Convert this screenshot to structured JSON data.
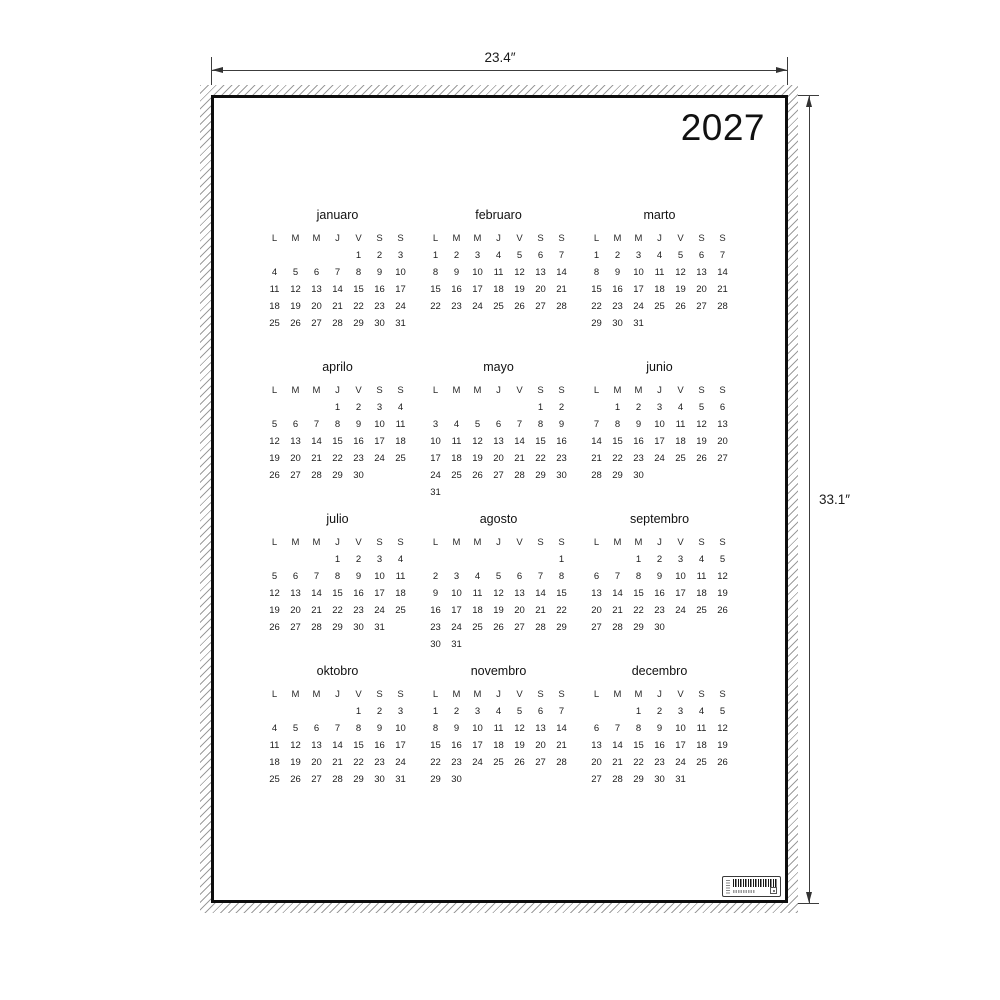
{
  "dimension_annotations": {
    "width_label": "23.4″",
    "height_label": "33.1″"
  },
  "poster": {
    "year": "2027",
    "day_headers": [
      "L",
      "M",
      "M",
      "J",
      "V",
      "S",
      "S"
    ],
    "months": [
      {
        "name": "januaro",
        "weeks": [
          [
            "",
            "",
            "",
            "",
            "1",
            "2",
            "3"
          ],
          [
            "4",
            "5",
            "6",
            "7",
            "8",
            "9",
            "10"
          ],
          [
            "11",
            "12",
            "13",
            "14",
            "15",
            "16",
            "17"
          ],
          [
            "18",
            "19",
            "20",
            "21",
            "22",
            "23",
            "24"
          ],
          [
            "25",
            "26",
            "27",
            "28",
            "29",
            "30",
            "31"
          ]
        ]
      },
      {
        "name": "februaro",
        "weeks": [
          [
            "1",
            "2",
            "3",
            "4",
            "5",
            "6",
            "7"
          ],
          [
            "8",
            "9",
            "10",
            "11",
            "12",
            "13",
            "14"
          ],
          [
            "15",
            "16",
            "17",
            "18",
            "19",
            "20",
            "21"
          ],
          [
            "22",
            "23",
            "24",
            "25",
            "26",
            "27",
            "28"
          ]
        ]
      },
      {
        "name": "marto",
        "weeks": [
          [
            "1",
            "2",
            "3",
            "4",
            "5",
            "6",
            "7"
          ],
          [
            "8",
            "9",
            "10",
            "11",
            "12",
            "13",
            "14"
          ],
          [
            "15",
            "16",
            "17",
            "18",
            "19",
            "20",
            "21"
          ],
          [
            "22",
            "23",
            "24",
            "25",
            "26",
            "27",
            "28"
          ],
          [
            "29",
            "30",
            "31",
            "",
            "",
            "",
            ""
          ]
        ]
      },
      {
        "name": "aprilo",
        "weeks": [
          [
            "",
            "",
            "",
            "1",
            "2",
            "3",
            "4"
          ],
          [
            "5",
            "6",
            "7",
            "8",
            "9",
            "10",
            "11"
          ],
          [
            "12",
            "13",
            "14",
            "15",
            "16",
            "17",
            "18"
          ],
          [
            "19",
            "20",
            "21",
            "22",
            "23",
            "24",
            "25"
          ],
          [
            "26",
            "27",
            "28",
            "29",
            "30",
            "",
            ""
          ]
        ]
      },
      {
        "name": "mayo",
        "weeks": [
          [
            "",
            "",
            "",
            "",
            "",
            "1",
            "2"
          ],
          [
            "3",
            "4",
            "5",
            "6",
            "7",
            "8",
            "9"
          ],
          [
            "10",
            "11",
            "12",
            "13",
            "14",
            "15",
            "16"
          ],
          [
            "17",
            "18",
            "19",
            "20",
            "21",
            "22",
            "23"
          ],
          [
            "24",
            "25",
            "26",
            "27",
            "28",
            "29",
            "30"
          ],
          [
            "31",
            "",
            "",
            "",
            "",
            "",
            ""
          ]
        ]
      },
      {
        "name": "junio",
        "weeks": [
          [
            "",
            "1",
            "2",
            "3",
            "4",
            "5",
            "6"
          ],
          [
            "7",
            "8",
            "9",
            "10",
            "11",
            "12",
            "13"
          ],
          [
            "14",
            "15",
            "16",
            "17",
            "18",
            "19",
            "20"
          ],
          [
            "21",
            "22",
            "23",
            "24",
            "25",
            "26",
            "27"
          ],
          [
            "28",
            "29",
            "30",
            "",
            "",
            "",
            ""
          ]
        ]
      },
      {
        "name": "julio",
        "weeks": [
          [
            "",
            "",
            "",
            "1",
            "2",
            "3",
            "4"
          ],
          [
            "5",
            "6",
            "7",
            "8",
            "9",
            "10",
            "11"
          ],
          [
            "12",
            "13",
            "14",
            "15",
            "16",
            "17",
            "18"
          ],
          [
            "19",
            "20",
            "21",
            "22",
            "23",
            "24",
            "25"
          ],
          [
            "26",
            "27",
            "28",
            "29",
            "30",
            "31",
            ""
          ]
        ]
      },
      {
        "name": "agosto",
        "weeks": [
          [
            "",
            "",
            "",
            "",
            "",
            "",
            "1"
          ],
          [
            "2",
            "3",
            "4",
            "5",
            "6",
            "7",
            "8"
          ],
          [
            "9",
            "10",
            "11",
            "12",
            "13",
            "14",
            "15"
          ],
          [
            "16",
            "17",
            "18",
            "19",
            "20",
            "21",
            "22"
          ],
          [
            "23",
            "24",
            "25",
            "26",
            "27",
            "28",
            "29"
          ],
          [
            "30",
            "31",
            "",
            "",
            "",
            "",
            ""
          ]
        ]
      },
      {
        "name": "septembro",
        "weeks": [
          [
            "",
            "",
            "1",
            "2",
            "3",
            "4",
            "5"
          ],
          [
            "6",
            "7",
            "8",
            "9",
            "10",
            "11",
            "12"
          ],
          [
            "13",
            "14",
            "15",
            "16",
            "17",
            "18",
            "19"
          ],
          [
            "20",
            "21",
            "22",
            "23",
            "24",
            "25",
            "26"
          ],
          [
            "27",
            "28",
            "29",
            "30",
            "",
            "",
            ""
          ]
        ]
      },
      {
        "name": "oktobro",
        "weeks": [
          [
            "",
            "",
            "",
            "",
            "1",
            "2",
            "3"
          ],
          [
            "4",
            "5",
            "6",
            "7",
            "8",
            "9",
            "10"
          ],
          [
            "11",
            "12",
            "13",
            "14",
            "15",
            "16",
            "17"
          ],
          [
            "18",
            "19",
            "20",
            "21",
            "22",
            "23",
            "24"
          ],
          [
            "25",
            "26",
            "27",
            "28",
            "29",
            "30",
            "31"
          ]
        ]
      },
      {
        "name": "novembro",
        "weeks": [
          [
            "1",
            "2",
            "3",
            "4",
            "5",
            "6",
            "7"
          ],
          [
            "8",
            "9",
            "10",
            "11",
            "12",
            "13",
            "14"
          ],
          [
            "15",
            "16",
            "17",
            "18",
            "19",
            "20",
            "21"
          ],
          [
            "22",
            "23",
            "24",
            "25",
            "26",
            "27",
            "28"
          ],
          [
            "29",
            "30",
            "",
            "",
            "",
            "",
            ""
          ]
        ]
      },
      {
        "name": "decembro",
        "weeks": [
          [
            "",
            "",
            "1",
            "2",
            "3",
            "4",
            "5"
          ],
          [
            "6",
            "7",
            "8",
            "9",
            "10",
            "11",
            "12"
          ],
          [
            "13",
            "14",
            "15",
            "16",
            "17",
            "18",
            "19"
          ],
          [
            "20",
            "21",
            "22",
            "23",
            "24",
            "25",
            "26"
          ],
          [
            "27",
            "28",
            "29",
            "30",
            "31",
            "",
            ""
          ]
        ]
      }
    ],
    "label": {
      "elements": [
        "label-vertical-microtext",
        "barcode-icon",
        "label-microtext",
        "label-mark"
      ]
    },
    "colors": {
      "ink": "#111111",
      "border": "#0d0d0d",
      "hatch": "#9c9c9c",
      "background": "#ffffff"
    }
  }
}
